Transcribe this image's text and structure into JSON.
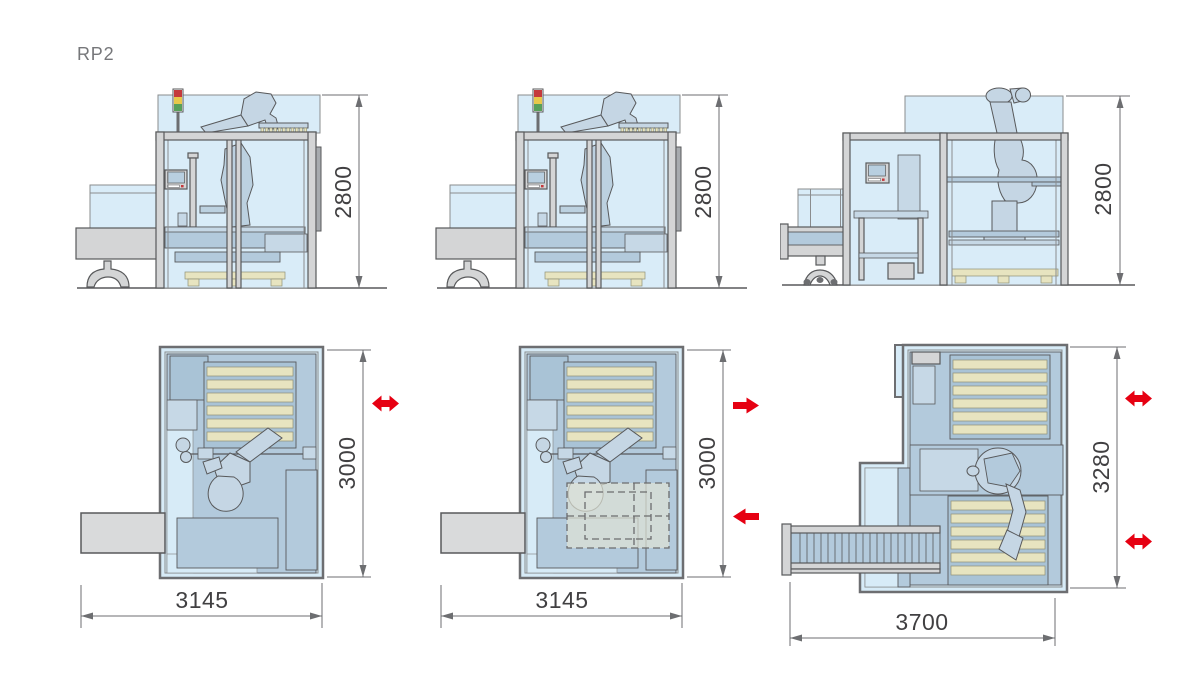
{
  "page": {
    "model_label": "RP2",
    "background": "#ffffff"
  },
  "colors": {
    "accent_red": "#e60012",
    "glass_blue": "#d9ecf8",
    "panel_blue": "#d7ebf7",
    "machine_blue": "#b3cadc",
    "machine_blue_dark": "#a9c3d6",
    "machine_blue_light": "#c6d8e6",
    "robot_blue": "#c5d6e4",
    "pallet_beige": "#e7e4c0",
    "frame_gray": "#d4d5d6",
    "outline_gray": "#58595b",
    "dimension_gray": "#6d6e71",
    "dimension_text": "#414042",
    "label_gray": "#76777a",
    "signal_red": "#c5393c",
    "signal_yellow": "#e8c84b",
    "signal_green": "#58a05a"
  },
  "figures": {
    "side_views": [
      {
        "id": "side-view-1",
        "height_label": "2800"
      },
      {
        "id": "side-view-2",
        "height_label": "2800"
      },
      {
        "id": "side-view-3",
        "height_label": "2800"
      }
    ],
    "top_views": [
      {
        "id": "top-view-1",
        "depth_label": "3000",
        "width_label": "3145",
        "arrow_icons": [
          "double-horizontal-arrow"
        ]
      },
      {
        "id": "top-view-2",
        "depth_label": "3000",
        "width_label": "3145",
        "arrow_icons": [
          "right-arrow",
          "left-arrow"
        ]
      },
      {
        "id": "top-view-3",
        "depth_label": "3280",
        "width_label": "3700",
        "arrow_icons": [
          "double-horizontal-arrow",
          "double-horizontal-arrow"
        ]
      }
    ]
  }
}
